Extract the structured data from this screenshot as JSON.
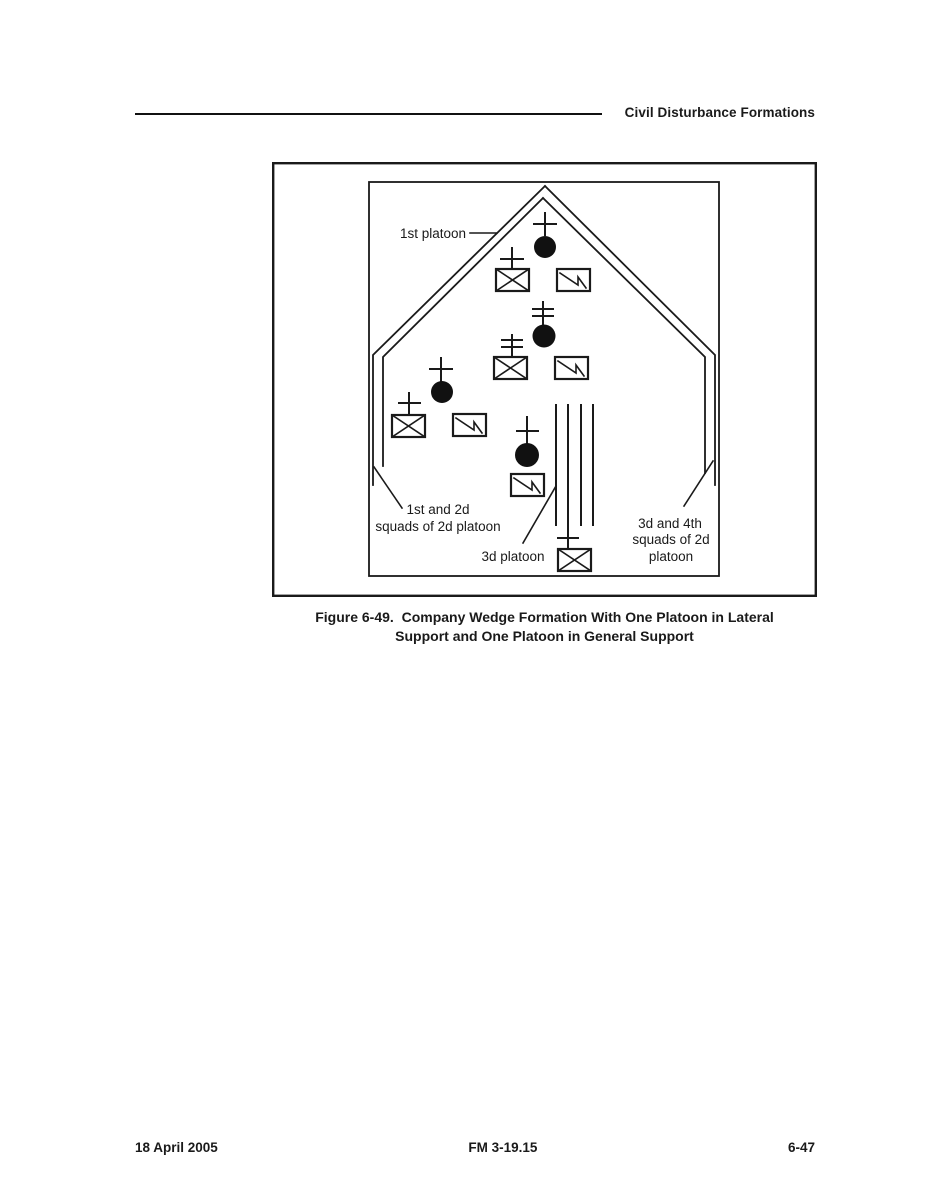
{
  "header": {
    "title": "Civil Disturbance Formations"
  },
  "figure": {
    "caption_line1": "Figure 6-49.  Company Wedge Formation With One Platoon in Lateral",
    "caption_line2": "Support and One Platoon in General Support",
    "labels": {
      "first_platoon": "1st platoon",
      "left_squads_1": "1st and 2d",
      "left_squads_2": "squads of 2d platoon",
      "third_platoon": "3d platoon",
      "right_squads_1": "3d and 4th",
      "right_squads_2": "squads of 2d",
      "right_squads_3": "platoon"
    },
    "symbols": {
      "platoon_leader": "filled-circle-with-cross-icon",
      "squad": "rectangle-with-x-icon",
      "support": "rectangle-with-lightning-bolt-icon",
      "column": "four-vertical-lines"
    },
    "colors": {
      "ink": "#1a1a1a",
      "paper": "#ffffff"
    }
  },
  "footer": {
    "date": "18 April 2005",
    "manual": "FM 3-19.15",
    "page_number": "6-47"
  }
}
